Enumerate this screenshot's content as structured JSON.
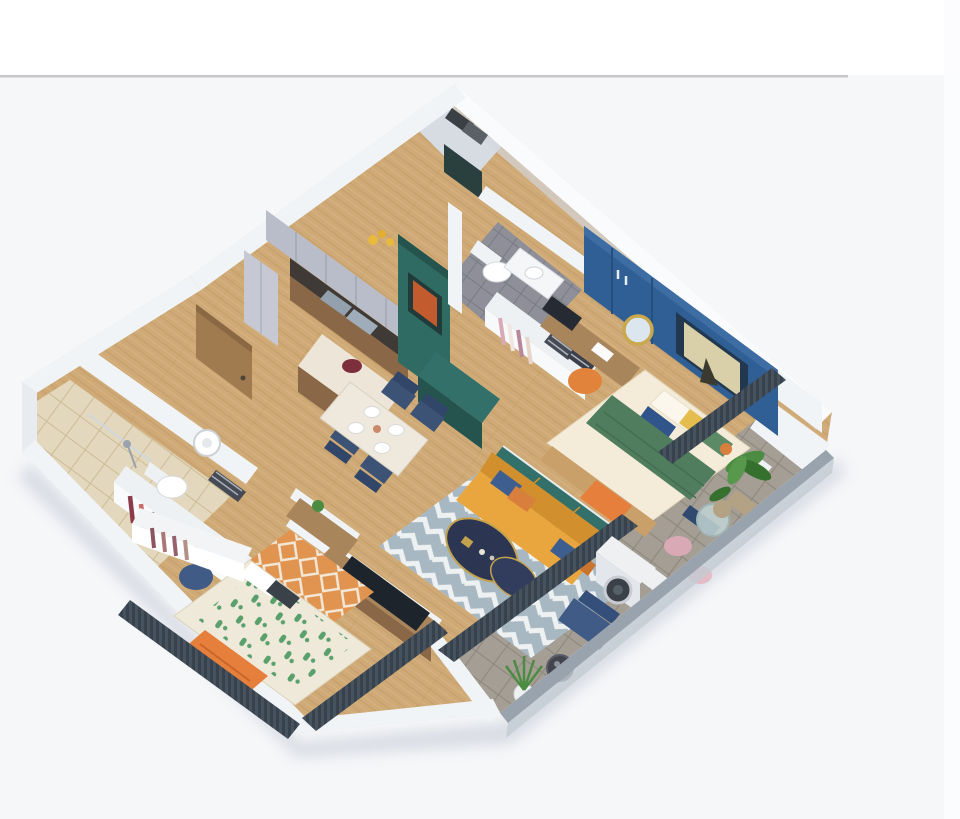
{
  "window": {
    "width": 960,
    "height": 819
  },
  "header": {
    "top_band_color": "#ffffff",
    "divider_color": "#c7c7c9",
    "page_color": "#f6f7f9",
    "right_strip_color": "#fcfcfe"
  },
  "palette": {
    "wall-top": "#fafbfd",
    "wall-face": "#f1f4f7",
    "wall-shade": "#d3d9e2",
    "wall-inner": "#e8ecf1",
    "floor-wood": "#d0aa76",
    "floor-wood-dark": "#b08a55",
    "tile-beige": "#e3d8bd",
    "tile-beige-line": "#ccbb95",
    "tile-gray": "#8e8f98",
    "tile-gray-line": "#797b84",
    "balcony-tile": "#a49e95",
    "balcony-tile-line": "#8f887d",
    "railing-gray": "#99a3ae",
    "railing-side": "#c2cad3",
    "accent-blue": "#2f5f95",
    "accent-blue-dark": "#264f80",
    "accent-blue-light": "#3d6da3",
    "teal-panel": "#2f6b62",
    "teal-panel-dark": "#24544d",
    "teal-console": "#33706a",
    "door-wood": "#a07b50",
    "door-wood-dark": "#8a6843",
    "cabinet-wood": "#8a6847",
    "cabinet-gray": "#b9bdc9",
    "counter-dark": "#3f3a35",
    "sink-steel": "#93a0ae",
    "sofa-orange": "#e9a63f",
    "sofa-orange-dark": "#d18f2e",
    "pillow-blue": "#3d5e8f",
    "pillow-orange": "#d97f3e",
    "rug-blue": "#a8b8c2",
    "rug-cream": "#eef1f2",
    "table-navy": "#2c3552",
    "table-gold": "#c3a24e",
    "chair-navy": "#3c5376",
    "chair-navy-dark": "#32466a",
    "dining-top": "#efe9dd",
    "bed-sheet": "#f4ecd9",
    "bed-green": "#4f7d5e",
    "pillow-yellow": "#e5bd4e",
    "pillow-green": "#5d8a66",
    "duvet-cream": "#efe9da",
    "duvet-green": "#59a06c",
    "rug-orange": "#e0944f",
    "blanket-orange": "#e67f3c",
    "curtain-dark": "#47525f",
    "curtain-dark-line": "#38424d",
    "plant-green": "#4c8b42",
    "plant-dark": "#35702f",
    "pot-tan": "#b3a284",
    "washer-white": "#eef0f2",
    "washer-dark": "#3a4148",
    "seat-pink": "#d9aab6",
    "glass-teal": "#c2d4d4",
    "mirror-gold": "#c9a84e",
    "art-orange": "#c25b2e",
    "art-frame": "#203b39",
    "wood-desk": "#a9855c",
    "white-furniture": "#f0f3f6",
    "shadow": "#bcc3cf"
  },
  "scene": {
    "type": "isometric-3d-floor-plan-render",
    "description": "3D cutaway render of a two-bedroom apartment with balcony",
    "rooms": [
      {
        "name": "kitchen",
        "items": [
          "upper-cabinets",
          "dark-countertop-with-sinks",
          "wood-base-cabinets",
          "tall-cabinet",
          "yellow-flowers"
        ]
      },
      {
        "name": "entry",
        "items": [
          "wood-entry-door",
          "teal-media-partition",
          "framed-orange-artwork",
          "dark-glass-panel"
        ]
      },
      {
        "name": "technical-shaft",
        "items": [
          "utility-units"
        ]
      },
      {
        "name": "dining-area",
        "items": [
          "marble-top-table",
          "four-navy-chairs",
          "wood-island-with-bowl",
          "teal-sideboard"
        ]
      },
      {
        "name": "living-room",
        "items": [
          "mustard-sofa",
          "blue-orange-pillows",
          "chevron-rug",
          "navy-oval-coffee-tables",
          "tv-on-wood-console",
          "dark-window-curtain"
        ]
      },
      {
        "name": "master-bedroom",
        "items": [
          "blue-accent-wall",
          "recessed-artwork",
          "blue-wardrobe",
          "double-bed-green-blanket",
          "pillows",
          "foot-bench",
          "desk",
          "laptop",
          "round-gold-mirror",
          "orange-pouf",
          "nightstand",
          "dark-window-curtain"
        ]
      },
      {
        "name": "ensuite-bathroom",
        "items": [
          "toilet",
          "vanity-sink",
          "towel-shelf",
          "hanging-clothes",
          "gray-tile-floor"
        ]
      },
      {
        "name": "second-bedroom",
        "items": [
          "bed-leaf-pattern-duvet",
          "orange-throw",
          "geometric-orange-rug",
          "open-wardrobe-with-clothes",
          "desk-with-plant",
          "blue-chair",
          "dark-window-curtains"
        ]
      },
      {
        "name": "main-bathroom",
        "items": [
          "toilet",
          "round-basin-vanity",
          "towel-cubbies",
          "shower-area",
          "beige-tile",
          "wood-door"
        ]
      },
      {
        "name": "balcony",
        "items": [
          "washing-machine",
          "laundry-unit",
          "potted-plants",
          "round-glass-table",
          "pink-seats",
          "blue-lounge-chair",
          "dark-side-table",
          "white-potted-plant",
          "gray-railing"
        ]
      }
    ]
  }
}
